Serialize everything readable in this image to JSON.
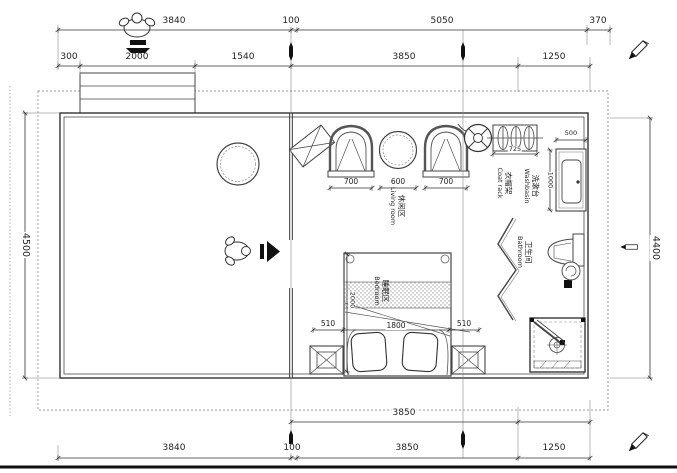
{
  "drawing": {
    "type": "residential floor plan"
  },
  "dims": {
    "top_row1": [
      "3840",
      "100",
      "5050",
      "370"
    ],
    "top_row2": [
      "300",
      "2000",
      "1540",
      "3850",
      "1250"
    ],
    "bottom_row1": [
      "3850"
    ],
    "bottom_row2": [
      "3840",
      "100",
      "3850",
      "1250"
    ],
    "left_side": "4500",
    "right_side": "4400",
    "seat_left": "700",
    "table": "600",
    "seat_right": "700",
    "bed_left": "510",
    "bed_width": "1800",
    "bed_right": "510",
    "bed_depth": "2000",
    "washbasin_width": "500",
    "washbasin_depth": "1000",
    "coat_rack_width": "725"
  },
  "rooms": {
    "living": {
      "zh": "休闲区",
      "en": "Living room"
    },
    "bedroom": {
      "zh": "睡眠区",
      "en": "Bedroom"
    },
    "bathroom": {
      "zh": "卫生间",
      "en": "Bathroom"
    },
    "washbasin": {
      "zh": "洗漱台",
      "en": "Washbasin"
    },
    "coat_rack": {
      "zh": "衣帽架",
      "en": "Coat rack"
    }
  }
}
